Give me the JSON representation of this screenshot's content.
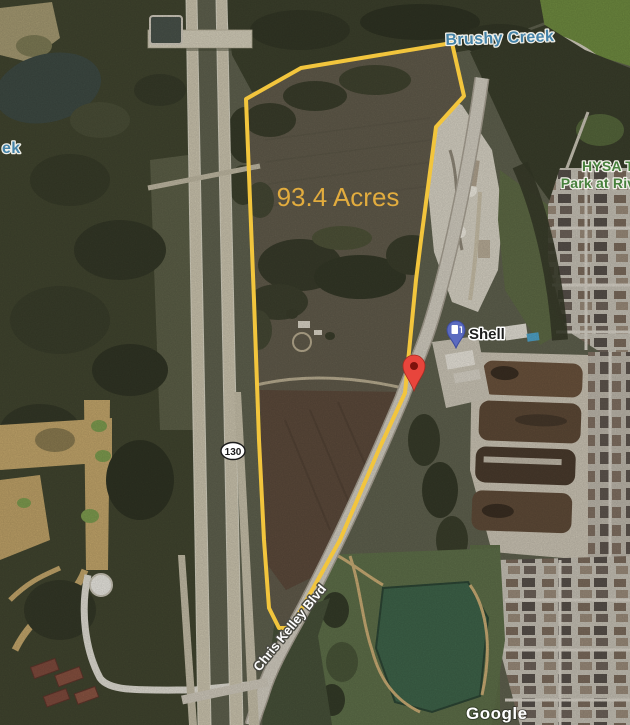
{
  "map": {
    "labels": {
      "creek": "Brushy Creek",
      "creek_partial": "ek",
      "park_line1": "HYSA T",
      "park_line2": "Park at Riv",
      "acreage": "93.4 Acres",
      "shell": "Shell",
      "highway_shield": "130",
      "road": "Chris Kelley Blvd",
      "watermark": "Google"
    },
    "colors": {
      "parcel_outline": "#F2C53D",
      "acreage_text": "#E2AC3E",
      "water_label": "#4583A8",
      "park_label": "#47803C",
      "red_pin": "#E8453C",
      "gas_pin": "#5B6BC0"
    }
  }
}
